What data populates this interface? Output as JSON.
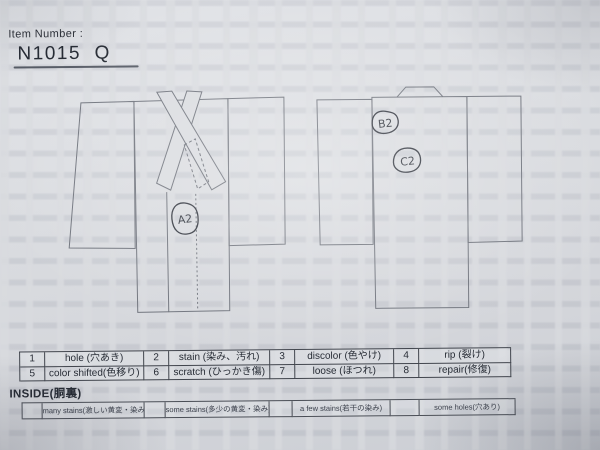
{
  "page": {
    "title_label": "Item Number :",
    "item_number": "N1015  Q"
  },
  "diagram": {
    "front_view_annotation": "A2",
    "back_view_annotations": {
      "shoulder": "B2",
      "center": "C2"
    }
  },
  "defect_legend": {
    "items": [
      {
        "code": "1",
        "label": "hole (穴あき)"
      },
      {
        "code": "2",
        "label": "stain (染み、汚れ)"
      },
      {
        "code": "3",
        "label": "discolor (色やけ)"
      },
      {
        "code": "4",
        "label": "rip (裂け)"
      },
      {
        "code": "5",
        "label": "color shifted(色移り)"
      },
      {
        "code": "6",
        "label": "scratch (ひっかき傷)"
      },
      {
        "code": "7",
        "label": "loose (ほつれ)"
      },
      {
        "code": "8",
        "label": "repair(修復)"
      }
    ]
  },
  "inside_legend": {
    "title": "INSIDE(胴裏)",
    "items": [
      {
        "label": "many stains(激しい黄変・染み)"
      },
      {
        "label": "some stains(多少の黄変・染み)"
      },
      {
        "label": "a few stains(若干の染み)"
      },
      {
        "label": "some holes(穴あり)"
      }
    ]
  },
  "colors": {
    "paper": "#d9dbdf",
    "ink": "#262b34",
    "outline": "#6f737c",
    "pen": "#2f333c"
  }
}
